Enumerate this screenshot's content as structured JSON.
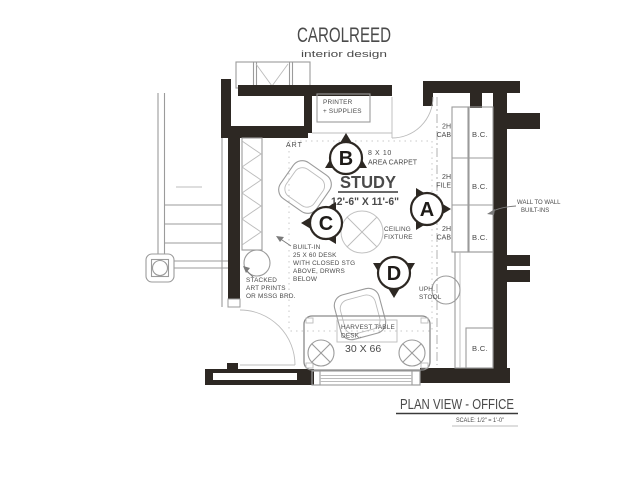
{
  "colors": {
    "wall": "#2d2823",
    "line": "#9b9b9b",
    "text": "#4a4a4a"
  },
  "brand": {
    "name": "CAROLREED",
    "tagline": "interior design"
  },
  "plan": {
    "room_title": "STUDY",
    "room_dimensions": "12'-6\" X 11'-6\"",
    "carpet": [
      "8 X 10",
      "AREA CARPET"
    ],
    "printer": [
      "PRINTER",
      "+ SUPPLIES"
    ],
    "art": "ART",
    "ceiling": [
      "CEILING",
      "FIXTURE"
    ],
    "built_in_desk": [
      "BUILT-IN",
      "25 X 60 DESK",
      "WITH CLOSED STG",
      "ABOVE, DRWRS",
      "BELOW"
    ],
    "stacked_art": [
      "STACKED",
      "ART PRINTS",
      "OR MSSG BRD."
    ],
    "harvest_table": [
      "HARVEST TABLE",
      "DESK.",
      "30 X 66"
    ],
    "stool": [
      "UPH.",
      "STOOL"
    ],
    "cab_labels": [
      [
        "2H",
        "CAB"
      ],
      [
        "2H",
        "FILE"
      ],
      [
        "2H",
        "CAB"
      ]
    ],
    "bc_labels": [
      "B.C.",
      "B.C.",
      "B.C.",
      "B.C."
    ],
    "wall_to_wall": [
      "WALL TO WALL",
      "BUILT-INS"
    ],
    "markers": [
      "A",
      "B",
      "C",
      "D"
    ]
  },
  "titleblock": {
    "title": "PLAN VIEW - OFFICE",
    "scale": "SCALE:  1/2\" = 1'-0\""
  }
}
